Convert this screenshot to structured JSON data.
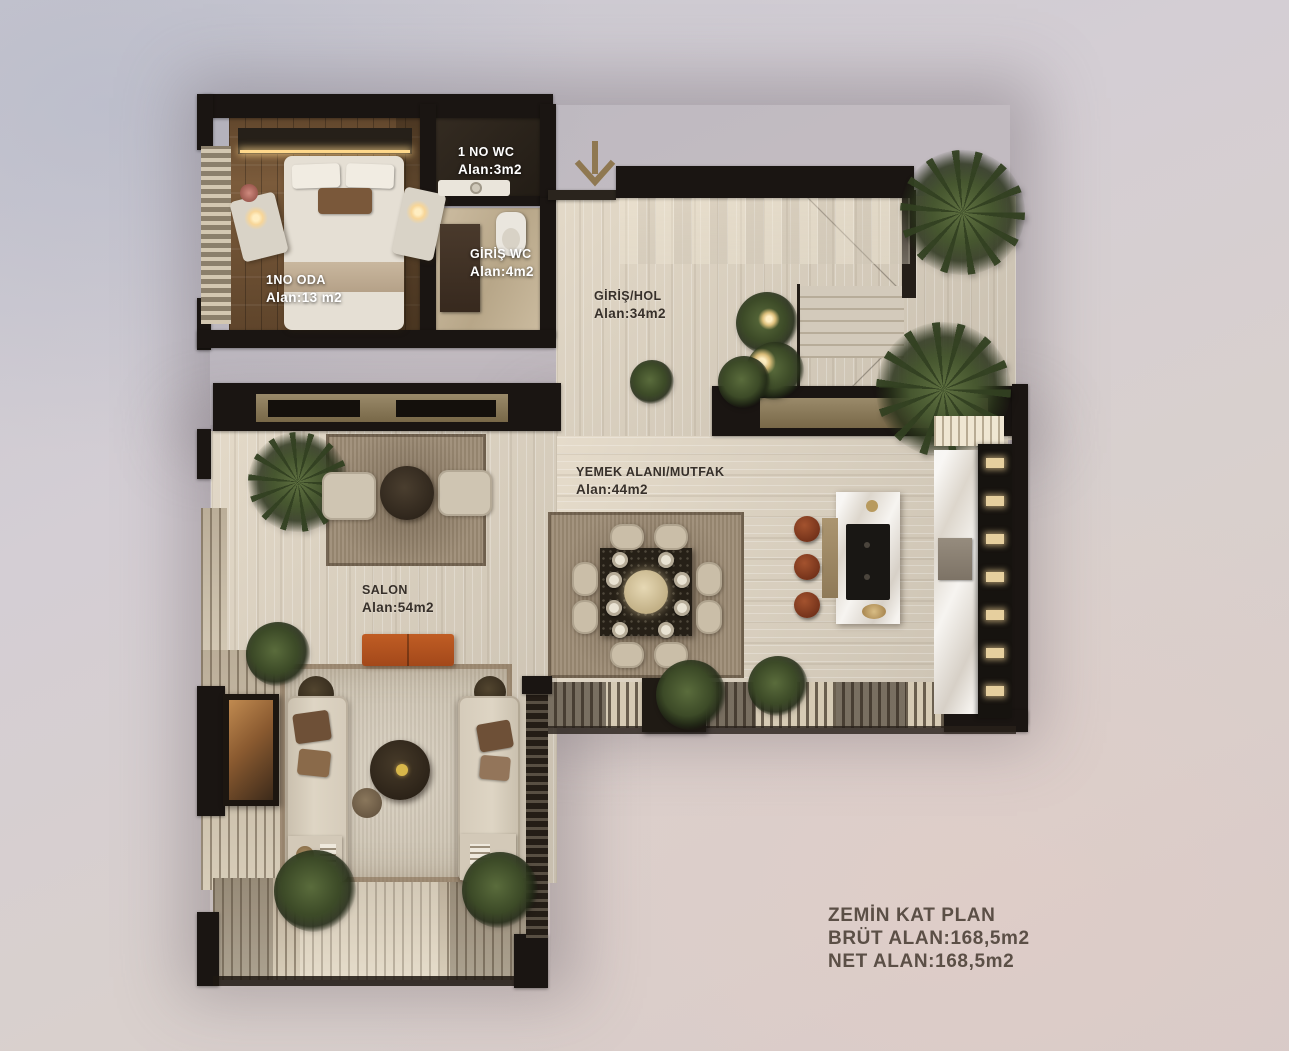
{
  "rooms": [
    {
      "name": "1 NO WC",
      "area": "Alan:3m2"
    },
    {
      "name": "GİRİŞ WC",
      "area": "Alan:4m2"
    },
    {
      "name": "1NO ODA",
      "area": "Alan:13 m2"
    },
    {
      "name": "GİRİŞ/HOL",
      "area": "Alan:34m2"
    },
    {
      "name": "YEMEK ALANI/MUTFAK",
      "area": "Alan:44m2"
    },
    {
      "name": "SALON",
      "area": "Alan:54m2"
    }
  ],
  "title_block": {
    "line1": "ZEMİN KAT PLAN",
    "line2": "BRÜT ALAN:168,5m2",
    "line3": "NET ALAN:168,5m2"
  },
  "icons": {
    "entrance_arrow": "arrow-down"
  },
  "colors": {
    "wall": "#1a1512",
    "stone_floor": "#d0c8b9",
    "wood_floor": "#7b5b3b",
    "accent_orange": "#b2521d",
    "stool_brown": "#8d4526",
    "bronze_panel": "#8b7b5e",
    "label_light": "#ffffff",
    "label_dark": "#37302a",
    "title_text": "#5b4f46",
    "palm_green": "#46562f",
    "lamp_glow": "#ffd98c",
    "arrow": "#8f7851"
  }
}
